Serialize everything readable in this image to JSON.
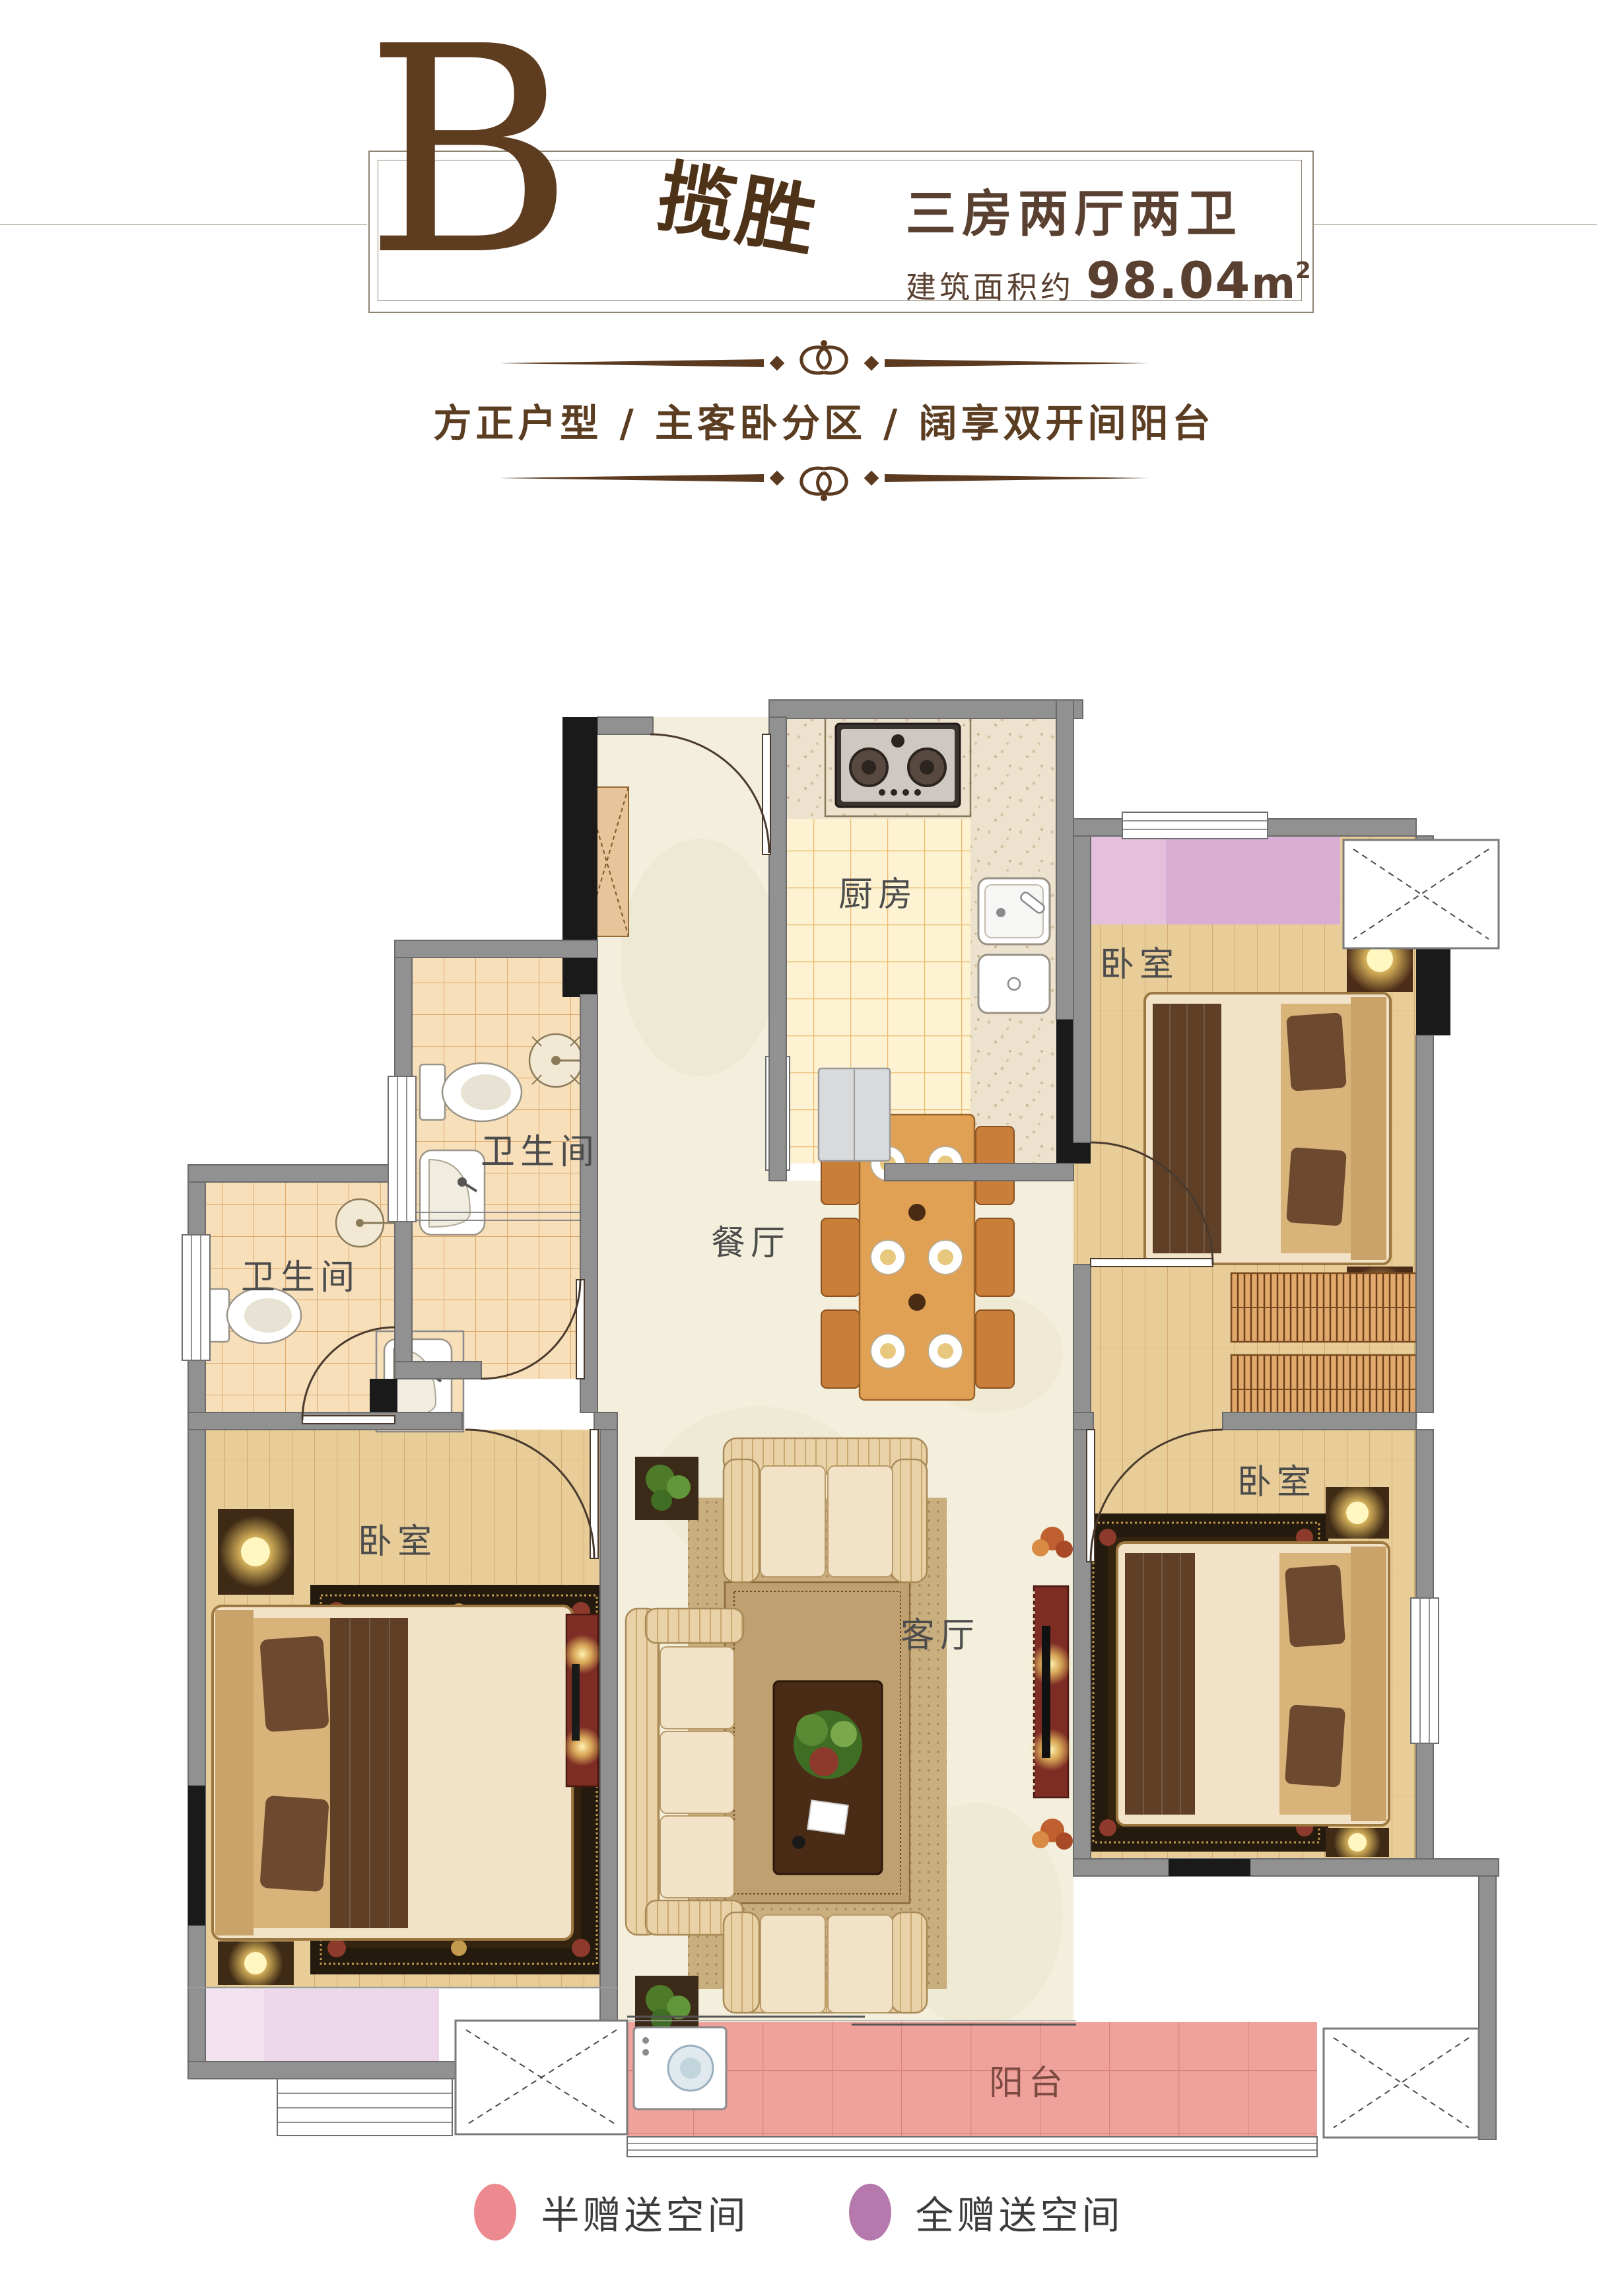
{
  "header": {
    "plan_letter": "B",
    "plan_name": "揽胜",
    "layout_type": "三房两厅两卫",
    "area_prefix": "建筑面积约",
    "area_value": "98.04",
    "area_unit": "m",
    "area_exponent": "2"
  },
  "tagline": {
    "text": "方正户型 / 主客卧分区 / 阔享双开间阳台"
  },
  "floorplan": {
    "rooms": {
      "kitchen": "厨房",
      "bedroom_top_right": "卧室",
      "bath_upper": "卫生间",
      "bath_lower": "卫生间",
      "dining": "餐厅",
      "living": "客厅",
      "bedroom_bottom_left": "卧室",
      "bedroom_bottom_right": "卧室",
      "balcony": "阳台"
    }
  },
  "legend": {
    "items": [
      {
        "label": "半赠送空间",
        "color": "#ed8a90"
      },
      {
        "label": "全赠送空间",
        "color": "#b679ae"
      }
    ]
  }
}
